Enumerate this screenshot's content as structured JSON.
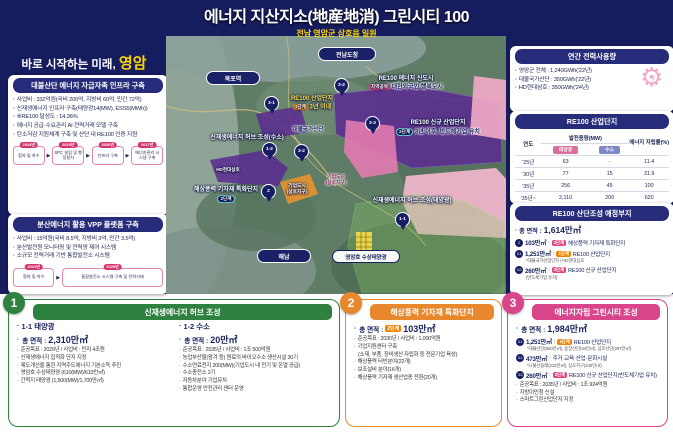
{
  "header": {
    "title": "에너지 지산지소(地産地消) 그린시티 100",
    "subtitle": "전남 영암군 삼호읍 일원"
  },
  "slogan": {
    "prefix": "바로 시작하는 미래, ",
    "highlight": "영암"
  },
  "left": {
    "panel1": {
      "title": "대불산단 에너지 자급자족 인프라 구축",
      "bullets": [
        "사업비 : 332억원(국비 200억, 지방비 60억, 민간 72억)",
        "신재생에너지 인프라 구축(태양광14(MW), ESS5(MWh))",
        "※RE100 달성도 : 14.36%",
        "에너지 공급·수요관리 AI 전력거래 모델 구축",
        "탄소저감 지원체계 구축 및 산단 내 RE100 인증 지원"
      ],
      "timeline": [
        {
          "year": "2024년",
          "label": "협약 및 착수"
        },
        {
          "year": "2025년",
          "label": "SPC 설립 및 행정절차"
        },
        {
          "year": "2026년",
          "label": "인프라 구축"
        },
        {
          "year": "2027년",
          "label": "에너지관리 시스템 구축"
        }
      ]
    },
    "panel2": {
      "title": "분산에너지 활용 VPP 플랫폼 구축",
      "bullets": [
        "사업비 : 15억원(국비 8.5억, 지방비 3억, 민간 3.5억)",
        "분산발전원 모니터링 및 전력망 제어 시스템",
        "소규모 전력거래 기반 통합발전소 시스템"
      ],
      "timeline": [
        {
          "year": "2024년",
          "label": "협약 및 착수"
        },
        {
          "year": "2025년",
          "label": "통합발전소 시스템 구축 및 전력거래"
        }
      ]
    }
  },
  "map": {
    "places": {
      "mokpo_station": "목포역",
      "jeonnam_office": "전남도청",
      "haenam": "해남",
      "lake_solar": "영암호 수상태양광"
    },
    "labels": {
      "re100_industrial": {
        "line1": "RE100 산업단지",
        "stage": "1단계",
        "line2": "3년 이내"
      },
      "daebul": "대불국가산단",
      "energy_city": {
        "line1": "RE100 에너지 신도시",
        "badge": "지역공약",
        "line2": "대한외국인 행복도시"
      },
      "new_industrial": {
        "line1": "RE100 신규 산업단지",
        "stage": "2단계",
        "line2": "3년 이후, 반도체기업 유치"
      },
      "hub_h2": "신재생에너지 허브 조성(수소)",
      "hub_solar": "신재생에너지 허브 조성(태양광)",
      "wind_cluster": {
        "line1": "해상풍력 기자재 특화단지",
        "stage": "2단계"
      },
      "biz_city_small": {
        "line1": "기업도시",
        "line2": "(삼호지구)"
      },
      "biz_city": {
        "line1": "기업도시",
        "line2": "(삼호지구)"
      },
      "hd_hyundai": "HD현대삼호"
    },
    "pins": {
      "p31": "3-1",
      "p32a": "3-2",
      "p12": "1-2",
      "p32b": "3-2",
      "p2": "2",
      "p33": "3-3",
      "p11": "1-1"
    }
  },
  "right": {
    "power": {
      "title": "연간 전력사용량",
      "bullets": [
        "영암군 전체 : 1,240GWh('22년)",
        "대불국가산단 : 350GWh('22년)",
        "HD현대삼호 : 350GWh('24년)"
      ]
    },
    "table": {
      "title": "RE100 산업단지",
      "col_year": "연도",
      "col_capacity": "발전용량(MW)",
      "col_solar": "태양광",
      "col_h2": "수소",
      "col_rate": "에너지 자립률(%)",
      "rows": [
        [
          "'25년",
          "63",
          "-",
          "11.4"
        ],
        [
          "'30년",
          "77",
          "15",
          "31.9"
        ],
        [
          "'35년",
          "256",
          "45",
          "100"
        ],
        [
          "'35년~",
          "2,110",
          "200",
          "620"
        ]
      ]
    },
    "sites": {
      "title": "RE100 산단조성 예정부지",
      "total_label": "총 면적 :",
      "total_value": "1,614만㎡",
      "items": [
        {
          "num": "2",
          "area": "103만㎡",
          "stage": "2단계",
          "text": "해상풍력 기자재 특화단지",
          "note": ""
        },
        {
          "num": "3-1",
          "area": "1,251만㎡",
          "stage": "1단계",
          "text": "RE100 산업단지",
          "note": "*대불국가산업단지 / HD현대삼호"
        },
        {
          "num": "3-2",
          "area": "260만㎡",
          "stage": "2단계",
          "text": "RE100 신규 산업단지",
          "note": "(반도체기업 유치)"
        }
      ]
    }
  },
  "bottom": {
    "panel1": {
      "num": "1",
      "title": "신재생에너지 허브 조성",
      "left": {
        "heading": "1-1 태양광",
        "area_label": "총 면적 :",
        "area_value": "2,310만㎡",
        "bullets": [
          "준공목표 : 2029년 / 사업비 : 민자 4조원",
          "신재생에너지 집적화 단지 지정",
          "제도개선을 통한 지역주도에너지 기본소득 추진",
          "영암호 수상태양광 (610(MW)/610만㎡)",
          "간척지 태양광 (1,500(MW)/1,700만㎡)"
        ]
      },
      "right": {
        "heading": "1-2 수소",
        "area_label": "총 면적 :",
        "area_value": "20만㎡",
        "bullets": [
          "준공목표 : 2035년 / 사업비 : 1조 500억원",
          "농업부산물(왕겨 등) 원료의 바이오수소 생산시설 30기",
          "수소연료전지 200(MW)(기업도시 내 전기 및 온열 공급)",
          "수소충전소 2기",
          "자동차분야 기업유치",
          "통합운영 안전관리 센터 운영"
        ]
      }
    },
    "panel2": {
      "num": "2",
      "title": "해상풍력 기자재 특화단지",
      "area_label": "총 면적 :",
      "stage": "2단계",
      "area_value": "103만㎡",
      "bullets": [
        "준공목표 : 2030년 / 사업비 : 1,000억원",
        "기업지원센터 구축",
        "(소재, 부품, 장비생산 자립화 등 전문기업 육성)",
        "해상풍력 터빈분야(22개)",
        "보조설비 분야(16개)",
        "해상풍력 기자재 생산업종 전환(20개)"
      ]
    },
    "panel3": {
      "num": "3",
      "title": "에너지자립 그린시티 조성",
      "area_label": "총 면적 :",
      "area_value": "1,984만㎡",
      "items": [
        {
          "num": "3-1",
          "area": "1,251만㎡",
          "stage": "1단계",
          "text": "RE100 산업단지",
          "note": "*대불산단(820만㎡), 용장산단(34만㎡), 삼호산단(297만㎡)"
        },
        {
          "num": "3-2",
          "area": "473만㎡",
          "text": "주거·교육·산업·문화시설",
          "note": "*나불산들래(233만㎡), 삼호지구(240만㎡)"
        },
        {
          "num": "3-3",
          "area": "260만㎡",
          "stage": "2단계",
          "text": "RE100 신규 산업단지(반도체기업 유치)",
          "note": ""
        }
      ],
      "bullets": [
        "준공목표 : 2035년 / 사업비 : 1조 924억원",
        "지방이민청 신설",
        "스마트그린산업단지 지정"
      ]
    }
  }
}
